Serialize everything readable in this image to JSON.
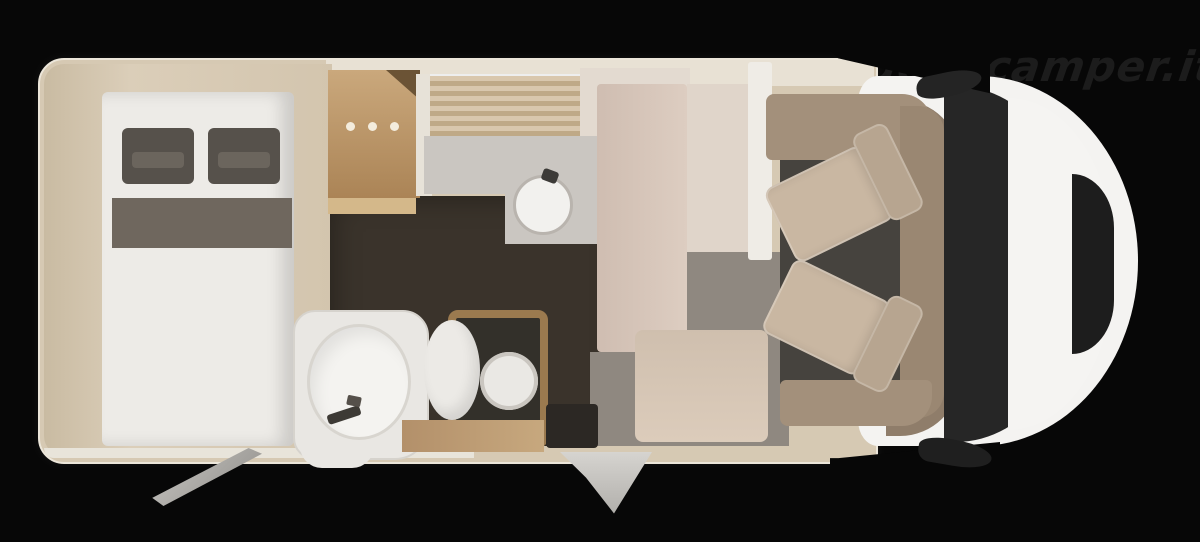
{
  "watermark": {
    "text": "nuovocamper.it"
  },
  "scene": {
    "type": "motorhome-floorplan-top-view",
    "vehicle_front": "right",
    "vehicle_rear": "left"
  },
  "colors": {
    "bg": "#070707",
    "watermark": "#1c1c1c",
    "body-tan": "#d6c9b3",
    "bed": "#edebe7",
    "pillow": "#56514b",
    "runner": "#6f675e",
    "dark-floor": "#3a332b",
    "bath-floor": "#cac6c1",
    "gray-floor": "#8f8880",
    "seat": "#c9b7a2",
    "surround": "#a3907b",
    "cab-white": "#f4f3f1",
    "windshield": "#262626"
  },
  "legend": [
    {
      "name": "island-bed",
      "desc": "rear double bed with two dark pillows and dark runner"
    },
    {
      "name": "kitchen-cabinet",
      "desc": "wood block with three burner dots"
    },
    {
      "name": "kitchen-counter",
      "desc": "striped worktop with round sink and faucet"
    },
    {
      "name": "bathroom",
      "desc": "shower tray, washbasin, wood-framed toilet"
    },
    {
      "name": "dinette",
      "desc": "beige bench and partitions mid-ship"
    },
    {
      "name": "cab",
      "desc": "two swivel seats, dashboard, windshield, hood, mirrors"
    },
    {
      "name": "entry-step",
      "desc": "step protruding from bottom side wall"
    }
  ]
}
